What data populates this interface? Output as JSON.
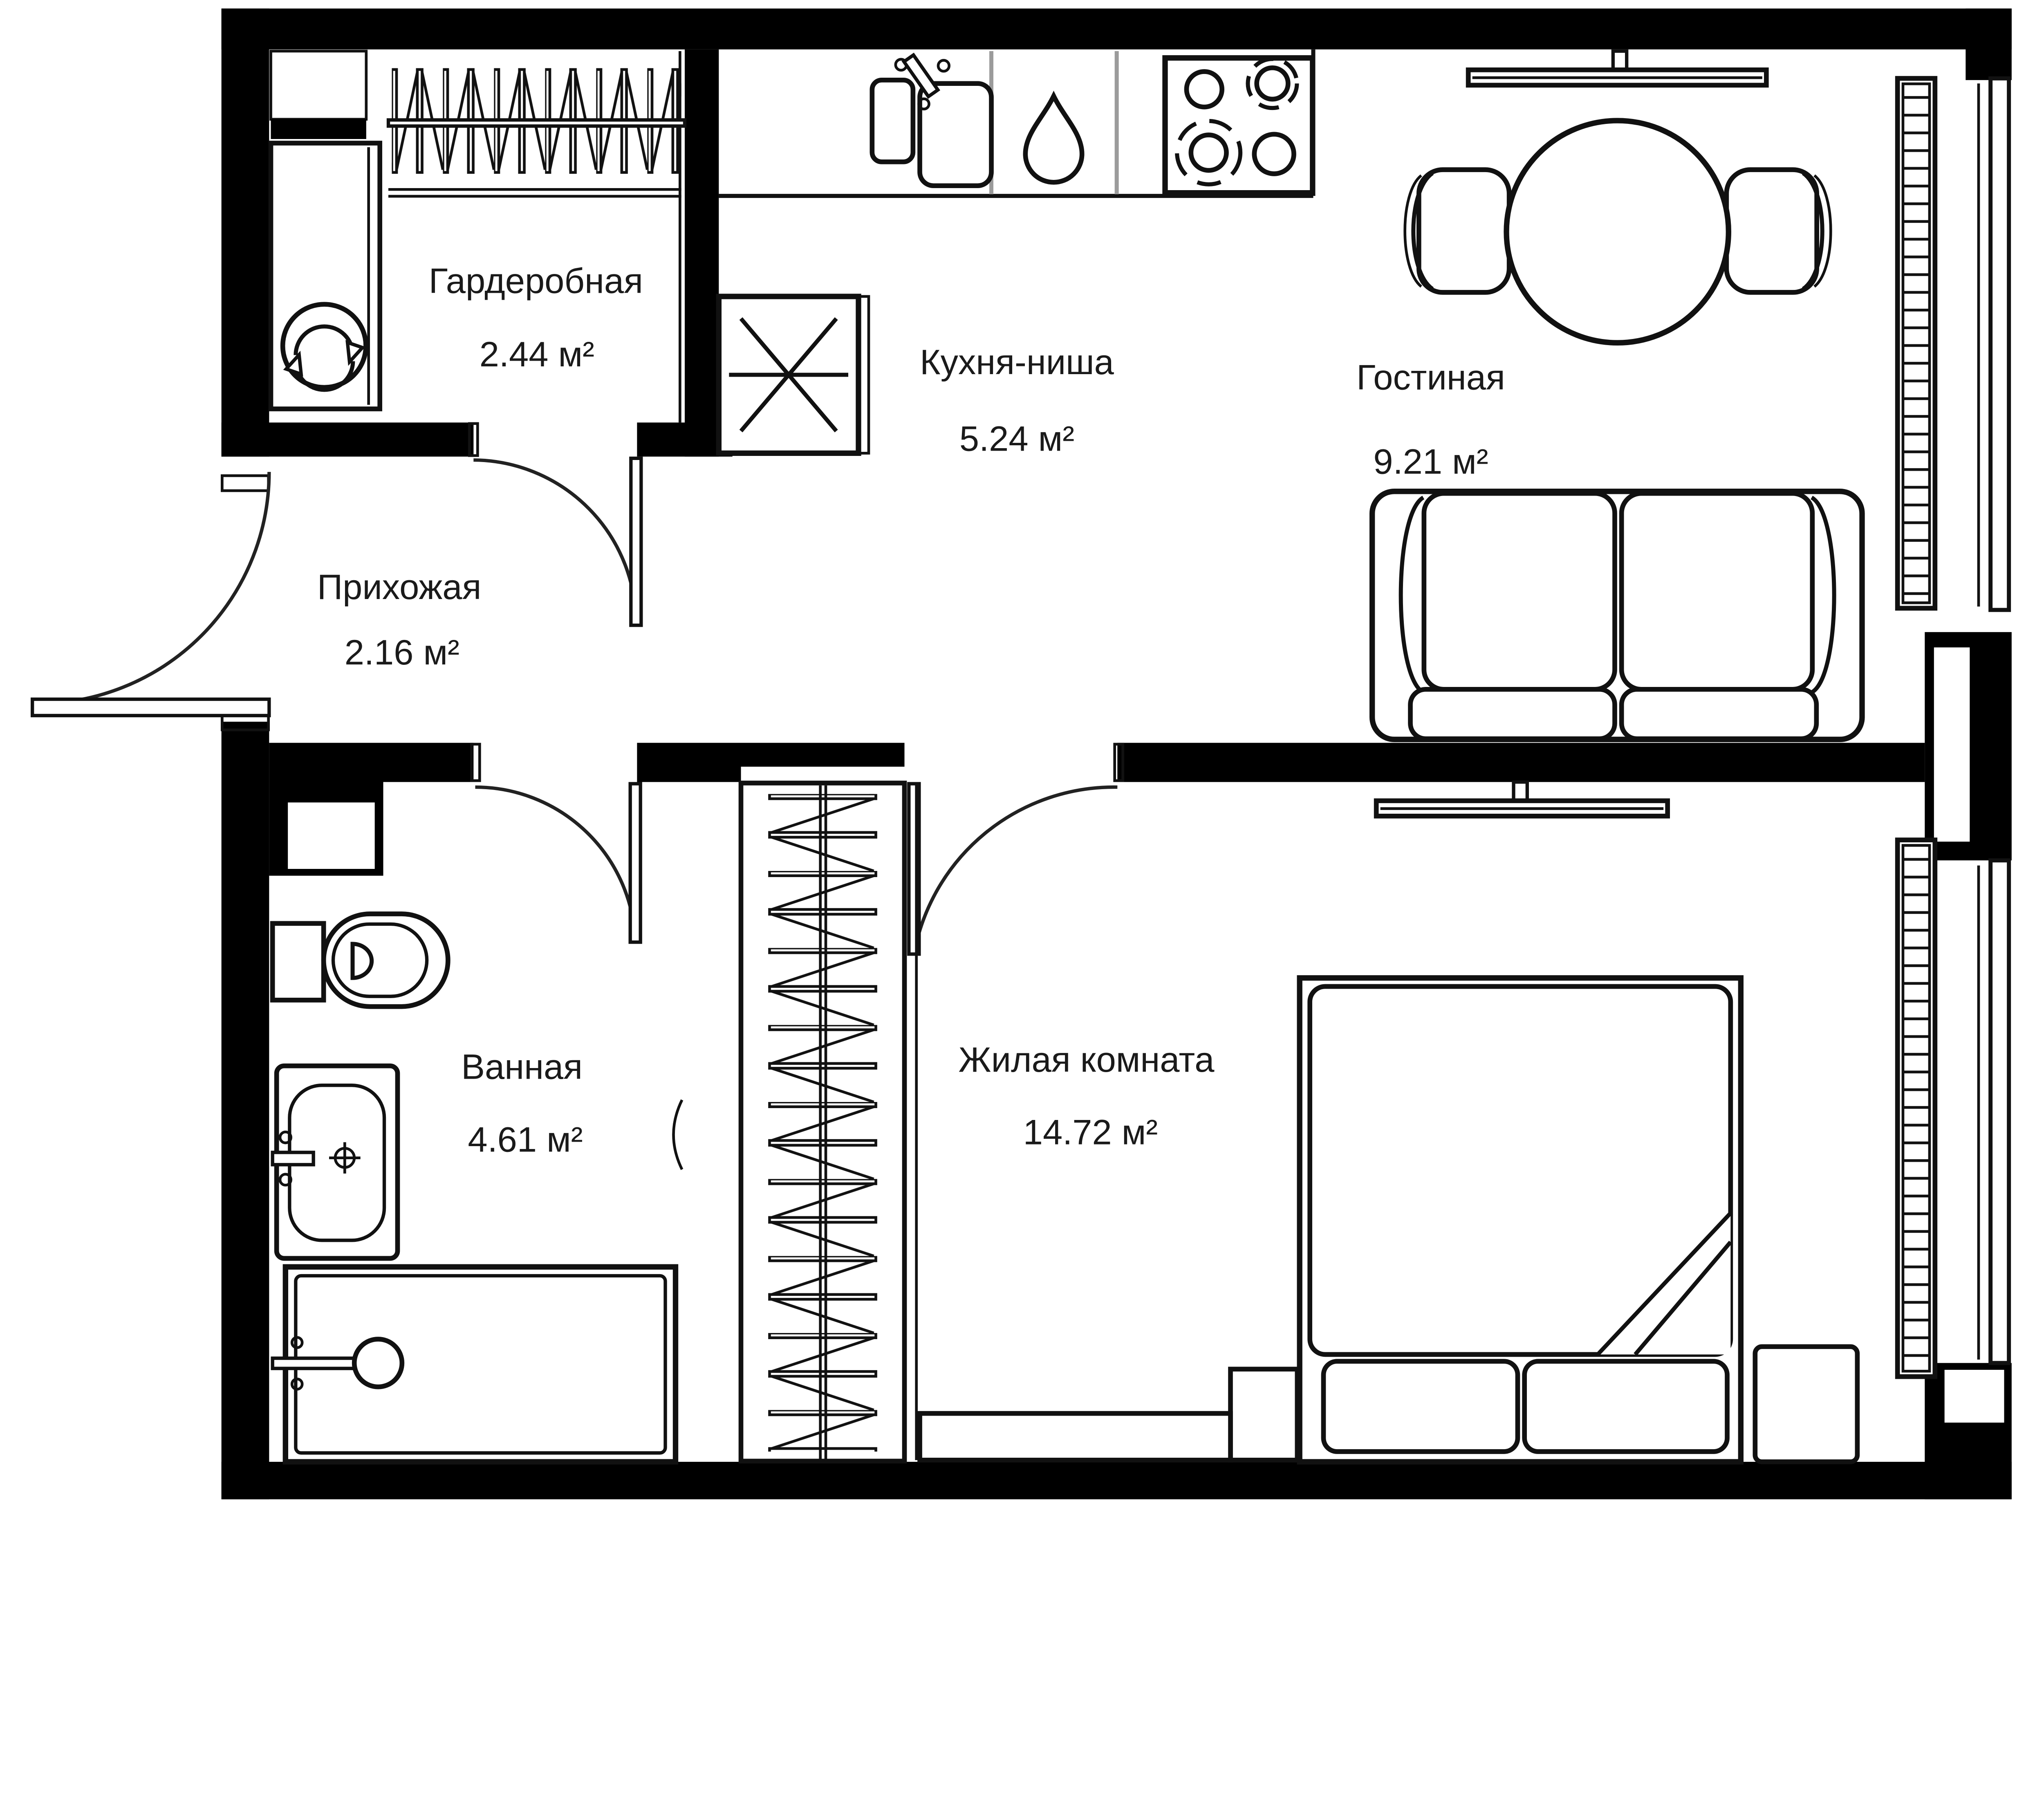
{
  "floorplan": {
    "type": "apartment-floor-plan",
    "language": "ru",
    "rooms": [
      {
        "id": "wardrobe",
        "label": "Гардеробная",
        "area": "2.44 м²"
      },
      {
        "id": "kitchen",
        "label": "Кухня-ниша",
        "area": "5.24 м²"
      },
      {
        "id": "living",
        "label": "Гостиная",
        "area": "9.21 м²"
      },
      {
        "id": "hallway",
        "label": "Прихожая",
        "area": "2.16 м²"
      },
      {
        "id": "bathroom",
        "label": "Ванная",
        "area": "4.61 м²"
      },
      {
        "id": "bedroom",
        "label": "Жилая комната",
        "area": "14.72 м²"
      }
    ],
    "icons": [
      "hanger-rail-icon",
      "washing-machine-icon",
      "vent-fan-icon",
      "kitchen-sink-icon",
      "water-drop-icon",
      "stove-icon",
      "tv-icon",
      "dining-table-icon",
      "chair-icon",
      "sofa-icon",
      "radiator-icon",
      "window",
      "door-arc",
      "toilet-icon",
      "washbasin-icon",
      "bathtub-icon",
      "shower-head-icon",
      "closet-hangers-icon",
      "bed-icon",
      "pillow",
      "nightstand",
      "dresser"
    ],
    "colors": {
      "walls": "#000000",
      "lines": "#111111",
      "background": "#ffffff",
      "unit_separator": "#9b9b9b",
      "text": "#1a1a1a"
    }
  }
}
